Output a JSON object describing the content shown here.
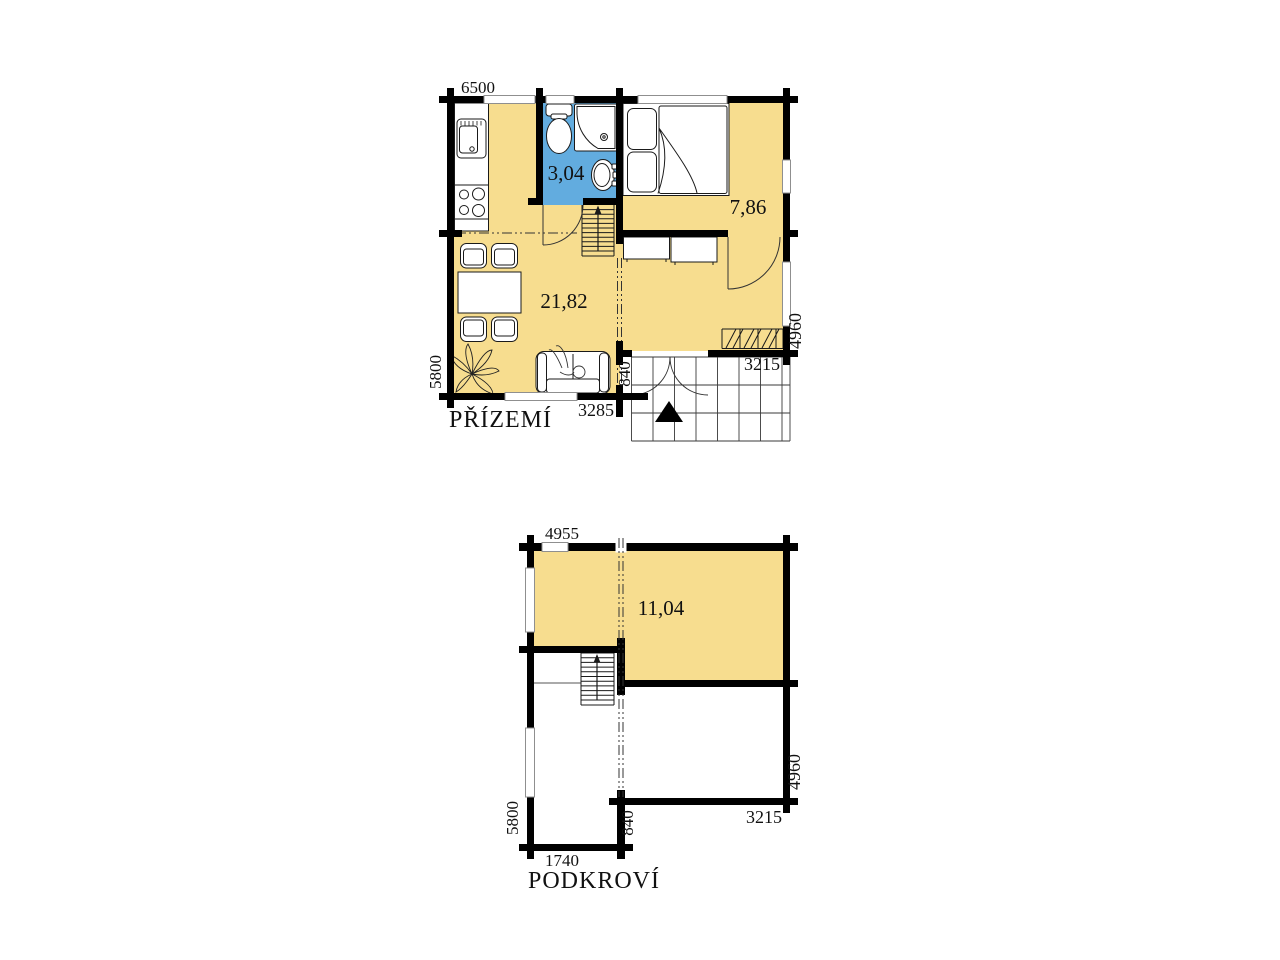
{
  "document": {
    "type": "floor-plan-drawing",
    "floors": [
      "PŘÍZEMÍ",
      "PODKROVÍ"
    ]
  },
  "colors": {
    "room_fill": "#F7DD8F",
    "bath_fill": "#62ACDF",
    "wall": "#000000",
    "line": "#1a1a1a",
    "grid": "#3a3a3a",
    "window_frame": "#8f8f8f"
  },
  "ground_floor": {
    "title": "PŘÍZEMÍ",
    "room_labels": {
      "bathroom": "3,04",
      "bedroom": "7,86",
      "living": "21,82"
    },
    "dims": {
      "width_top": "6500",
      "height_left": "5800",
      "living_bottom": "3285",
      "terrace_depth": "840",
      "terrace_width": "3215",
      "height_right": "4960"
    }
  },
  "attic_floor": {
    "title": "PODKROVÍ",
    "room_labels": {
      "room": "11,04"
    },
    "dims": {
      "width_top": "4955",
      "height_left": "5800",
      "bottom_left": "1740",
      "terrace_depth": "840",
      "bottom_right": "3215",
      "height_right": "4960"
    }
  }
}
